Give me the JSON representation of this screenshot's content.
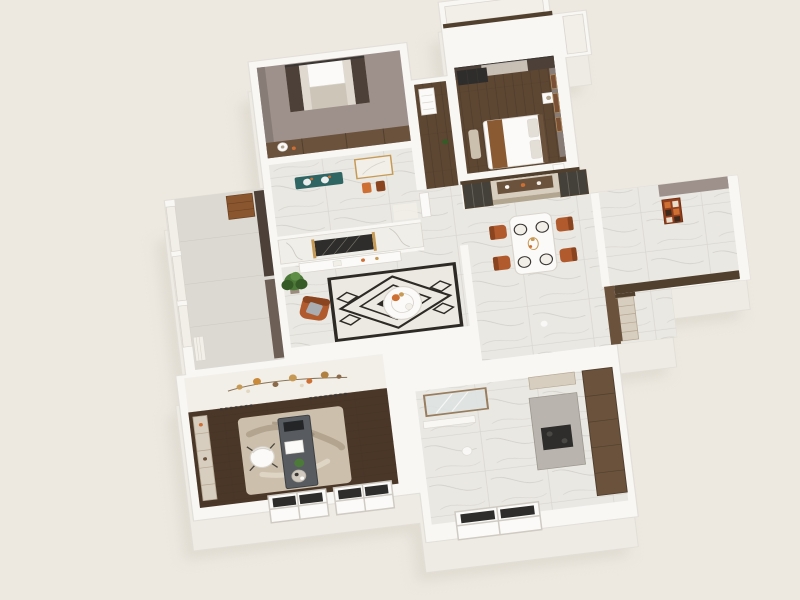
{
  "meta": {
    "description": "3D isometric architectural render of an apartment floor plan, viewed from above, on a plain cream backdrop. No visible text or UI controls.",
    "image_type": "floor-plan-render",
    "view": "top-down axonometric, rotated about 7 degrees"
  },
  "colors": {
    "bg": "#EDE9E1",
    "wall": "#F8F7F4",
    "walledge": "#E2DFD8",
    "base": "#EEEBE4",
    "shadow": "#D5CFC3",
    "mauve": "#9E918C",
    "mauve2": "#887C77",
    "wood": "#5D4733",
    "wood2": "#3F2F21",
    "studywood": "#4A3728",
    "marble": "#EAE8E3",
    "marble2": "#F0EEE9",
    "vein": "#B6B2AA",
    "balfloor": "#DCD9D3",
    "cab": "#6B523C",
    "cab2": "#52402E",
    "cream": "#D8CEBF",
    "cream2": "#B3A691",
    "rust": "#B05A2E",
    "rust2": "#8A4420",
    "teal": "#2F6663",
    "curtain": "#4C4038",
    "curtain2": "#6E5F56",
    "sheer": "#E4DFD6",
    "rugdk": "#2D2A26",
    "ruglt": "#ECE9E2",
    "srug": "#CCBFAC",
    "srug2": "#A1937C",
    "glass": "#DEE4E3",
    "gold": "#C69A55",
    "graphite": "#44413B",
    "green": "#4C7A38",
    "green2": "#365B27",
    "desk": "#585C60",
    "desk2": "#3C4044",
    "whitec": "#FBFAF8",
    "orange": "#CE6F33",
    "art": "#933F1D",
    "windark": "#2E2D2B",
    "soft": "#D9D5CD",
    "dark": "#3A3633",
    "gray1": "#A9ADB2",
    "beige": "#CBBFAE",
    "tan": "#CDC5B8",
    "blanket": "#8A5A33",
    "pot": "#9A8C7C",
    "artwood": "#7A5136",
    "paper": "#F2EFE9"
  },
  "scene": {
    "rooms": [
      {
        "id": "north-bedroom",
        "label": "Bedroom",
        "floor": "wood",
        "items": [
          "balcony window with brown curtains and sheers",
          "wardrobe band",
          "white table lamp"
        ]
      },
      {
        "id": "master-bedroom",
        "label": "Master Bedroom",
        "floor": "wood",
        "items": [
          "bed with white duvet and brown throw",
          "pillows",
          "nightstands with lamps",
          "dark wardrobe",
          "brown curtains with sheers",
          "art panel wall",
          "beige bench"
        ]
      },
      {
        "id": "bathroom",
        "label": "Bathroom",
        "floor": "marble",
        "items": [
          "teal vanity with twin sinks",
          "gold framed mirror",
          "orange towels"
        ]
      },
      {
        "id": "living-room",
        "label": "Living Room",
        "floor": "marble",
        "items": [
          "marble TV wall with dark inset and gold trim",
          "white media console",
          "potted plant",
          "rust armchair with gray pillow",
          "black and white geometric rug",
          "round white coffee table with orange flowers"
        ]
      },
      {
        "id": "balcony",
        "label": "Balcony",
        "floor": "gray tile",
        "items": [
          "white framed windows",
          "brown curtains",
          "rust cabinet",
          "radiator"
        ]
      },
      {
        "id": "dining-room",
        "label": "Dining Room",
        "floor": "marble",
        "items": [
          "built-in wall with smoked-glass display cabinets",
          "cream open shelving",
          "white dining table",
          "four rust dining chairs",
          "four place settings",
          "gold centerpiece"
        ]
      },
      {
        "id": "hallway",
        "label": "Hallway",
        "floor": "marble",
        "items": [
          "shoe cabinet",
          "wood-capped half walls",
          "ceiling light"
        ]
      },
      {
        "id": "entry",
        "label": "Entry",
        "floor": "marble",
        "items": [
          "orange abstract artwork on mauve wall"
        ]
      },
      {
        "id": "study",
        "label": "Study",
        "floor": "dark wood",
        "items": [
          "gray desk with laptop and papers",
          "white swivel chair",
          "beige abstract rug",
          "cream bookshelf",
          "gold branch wall sculpture",
          "two windows"
        ]
      },
      {
        "id": "kitchen-bath",
        "label": "Kitchen / Bath",
        "floor": "marble",
        "items": [
          "wood framed glass shower screen",
          "tall wood cabinets",
          "counter with dark cooktop",
          "cream upper cabinets",
          "ceiling light",
          "window"
        ]
      }
    ],
    "exterior": [
      "white perimeter walls",
      "white roof block above master bedroom",
      "entry wing protruding right",
      "stepped lower facade with windows"
    ]
  }
}
